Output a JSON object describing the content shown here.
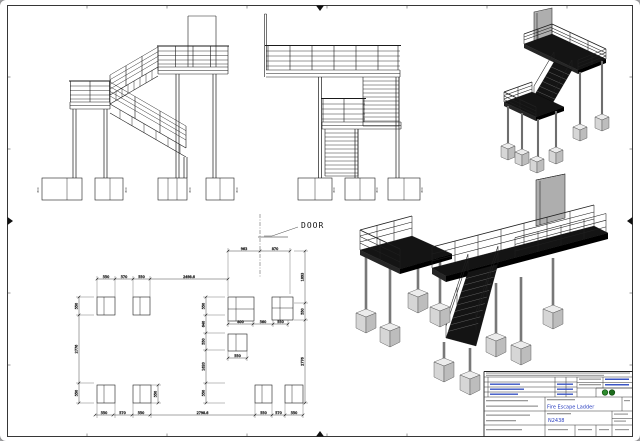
{
  "labels": {
    "door": "DOOR"
  },
  "plan": {
    "door_chain": [
      "963",
      "870"
    ],
    "top_chain": [
      "550",
      "570",
      "550",
      "2498.6"
    ],
    "left_chain": [
      "550",
      "2776",
      "550"
    ],
    "mid_v_chain": [
      "550",
      "640",
      "550",
      "1620",
      "550"
    ],
    "mid_h_chain": [
      "800",
      "560",
      "550"
    ],
    "right_chain": [
      "1893",
      "550",
      "2776"
    ],
    "bottom_chain": [
      "550",
      "570",
      "550",
      "2798.6",
      "550",
      "570",
      "550"
    ],
    "center_pad_dim": "550",
    "side_pad_dim": "550"
  },
  "elevation": {
    "footing_dim": "600"
  },
  "title_block": {
    "title": "Fire Escape Ladder",
    "drawing_number": "N2438"
  },
  "colors": {
    "accent_blue": "#2a3fc0",
    "logo_green": "#2e8b2e",
    "paper": "#ffffff",
    "line": "#1a1a1a"
  }
}
